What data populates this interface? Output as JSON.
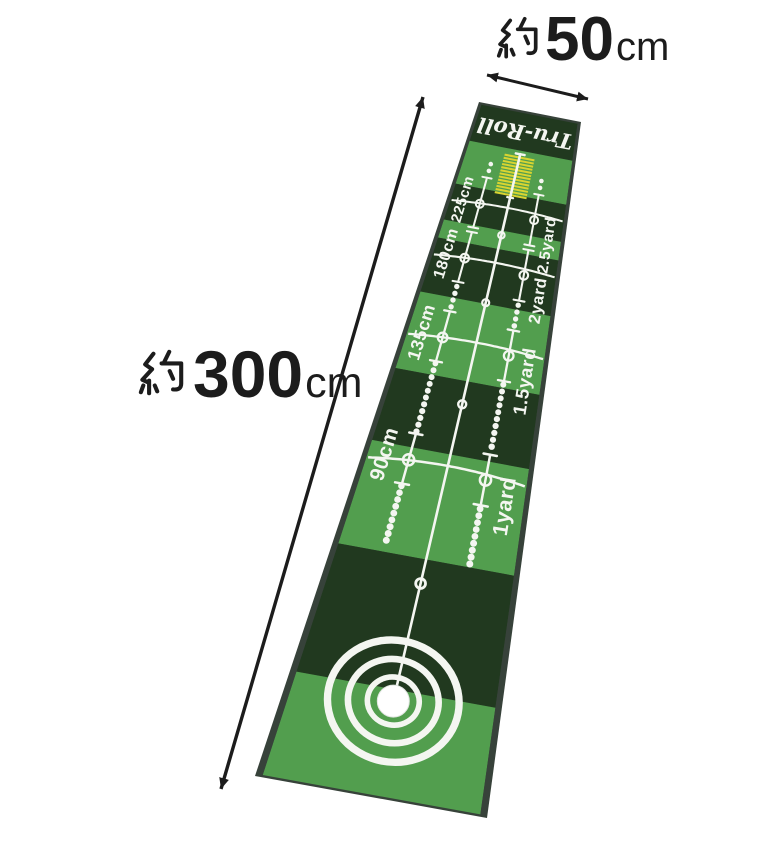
{
  "annotations": {
    "width": {
      "prefix": "約",
      "value": "50",
      "unit": "cm"
    },
    "length": {
      "prefix": "約",
      "value": "300",
      "unit": "cm"
    }
  },
  "mat": {
    "brand": "Tru-Roll",
    "distance_markers": [
      {
        "cm": "225cm",
        "yard": "2.5yard"
      },
      {
        "cm": "180cm",
        "yard": "2yard"
      },
      {
        "cm": "135cm",
        "yard": "1.5yard"
      },
      {
        "cm": "90cm",
        "yard": "1yard"
      }
    ],
    "colors": {
      "green": "#529e4e",
      "dark_green": "#21391f",
      "edge": "#37423a",
      "stripe_yellow": "#d9d431",
      "line_white": "#f4f6f1",
      "ball_white": "#ffffff",
      "annotation_text": "#1c1c1c",
      "background": "#ffffff"
    }
  }
}
